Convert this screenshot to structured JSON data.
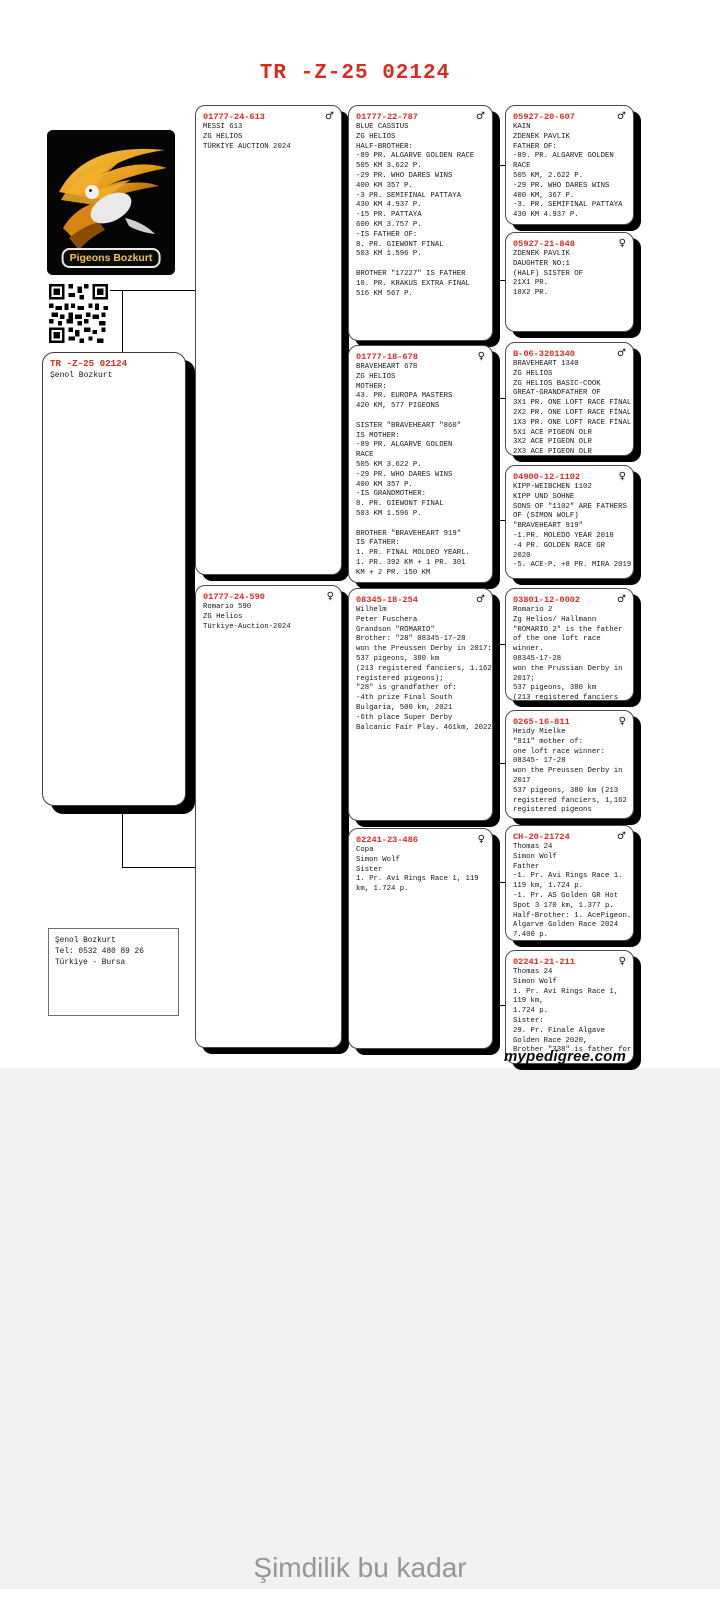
{
  "title": "TR -Z-25 02124",
  "logo": {
    "label": "Pigeons Bozkurt"
  },
  "subject": {
    "ring": "TR -Z-25 02124",
    "owner": "Şenol Bozkurt"
  },
  "contact": {
    "lines": [
      "Şenol Bozkurt",
      "Tel: 0532 480 89 26",
      "Türkiye - Bursa"
    ]
  },
  "footer": {
    "site": "mypedigree.com",
    "end_text": "Şimdilik bu kadar"
  },
  "cards": [
    {
      "ring": "01777-24-613",
      "sex": "m",
      "lines": [
        "MESSI 613",
        "ZG HELIOS",
        "TÜRKİYE AUCTION 2024"
      ]
    },
    {
      "ring": "01777-22-787",
      "sex": "m",
      "lines": [
        "BLUE CASSIUS",
        "ZG HELIOS",
        "HALF-BROTHER:",
        "-89 PR. ALGARVE GOLDEN RACE",
        "505 KM 3.622 P.",
        "-29 PR. WHO DARES WINS",
        "400 KM 357 P.",
        "-3 PR. SEMIFINAL PATTAYA",
        "430 KM 4.937 P.",
        "-15 PR. PATTAYA",
        "600 KM 3.757 P.",
        "-IS FATHER OF:",
        "8. PR. GIEWONT FINAL",
        "503 KM 1.596 P.",
        "",
        "BROTHER \"17227\" IS FATHER",
        "10. PR. KRAKUS EXTRA FINAL",
        "516 KM 567 P."
      ]
    },
    {
      "ring": "05927-20-607",
      "sex": "m",
      "lines": [
        "KAIN",
        "ZDENEK PAVLIK",
        "FATHER OF:",
        "-89. PR. ALGARVE GOLDEN",
        "RACE",
        "505 KM, 2.622 P.",
        "-29 PR. WHO DARES WINS",
        "400 KM, 367 P.",
        "-3. PR. SEMIFINAL PATTAYA",
        "430 KM 4.937 P."
      ]
    },
    {
      "ring": "05927-21-848",
      "sex": "f",
      "lines": [
        "ZDENEK PAVLIK",
        "DAUGHTER NO:1",
        "(HALF) SISTER OF",
        "21X1 PR.",
        "18X2 PR."
      ]
    },
    {
      "ring": "01777-18-678",
      "sex": "f",
      "lines": [
        "BRAVEHEART 678",
        "ZG HELIOS",
        "MOTHER:",
        "43. PR. EUROPA MASTERS",
        "420 KM, 577 PIGEONS",
        "",
        "SISTER \"BRAVEHEART \"860\"",
        "IS MOTHER:",
        "-89 PR. ALGARVE GOLDEN",
        "RACE",
        "505 KM 3.622 P.",
        "-29 PR. WHO DARES WINS",
        "400 KM 357 P.",
        "-IS GRANDMOTHER:",
        "8. PR. GIEWONT FINAL",
        "503 KM 1.596 P.",
        "",
        "BROTHER \"BRAVEHEART 919\"",
        "IS FATHER:",
        "1. PR. FINAL MOLDEO YEARL.",
        "1. PR. 392 KM + 1 PR. 301",
        "KM + 2 PR. 150 KM"
      ]
    },
    {
      "ring": "B-06-3201340",
      "sex": "m",
      "lines": [
        "BRAVEHEART 1340",
        "ZG HELIOS",
        "ZG HELIOS BASIC-COOK",
        "GREAT-GRANDFATHER OF",
        "3X1 PR. ONE LOFT RACE FİNAL",
        "2X2 PR. ONE LOFT RACE FİNAL",
        "1X3 PR. ONE LOFT RACE FİNAL",
        "5X1 ACE PIGEON OLR",
        "3X2 ACE PIGEON OLR",
        "2X3 ACE PIGEON OLR"
      ]
    },
    {
      "ring": "04900-12-1102",
      "sex": "f",
      "lines": [
        "KIPP-WEIBCHEN 1102",
        "KIPP UND SOHNE",
        "SONS OF \"1102\" ARE FATHERS",
        "OF (SIMON WOLF)",
        "\"BRAVEHEART 919\"",
        "-1.PR. MOLEDO YEAR 2018",
        "-4 PR. GOLDEN RACE GR",
        "2020",
        "-5. ACE-P. +8 PR. MIRA 2019"
      ]
    },
    {
      "ring": "01777-24-590",
      "sex": "f",
      "lines": [
        "Romario 590",
        "ZG Helios",
        "Türkiye-Auction-2024"
      ]
    },
    {
      "ring": "08345-18-254",
      "sex": "m",
      "lines": [
        "Wilhelm",
        "Peter Fuschera",
        "Grandson \"ROMARIO\"",
        "Brother: \"28\" 08345-17-28",
        "won the Preussen Derby in 2017:",
        "537 pigeons, 380 km",
        "(213 registered fanciers, 1.162",
        "registered pigeons);",
        "\"28\" is grandfather of:",
        "-4th prize Final South",
        "Bulgaria, 500 km, 2021",
        "-6th place Super Derby",
        "Balcanic Fair Play. 461km, 2022"
      ]
    },
    {
      "ring": "03801-12-0002",
      "sex": "m",
      "lines": [
        "Romario 2",
        "Zg Helios/ Hallmann",
        "\"ROMARIO 2\" is the father",
        "of the one loft race",
        "winner.",
        "08345-17-28",
        "won the Prussian Derby in",
        "2017;",
        "537 pigeons, 380 km",
        "(213 registered fanciers"
      ]
    },
    {
      "ring": "0265-16-811",
      "sex": "f",
      "lines": [
        "Heidy Mielke",
        "\"811\" mother of:",
        "one loft race winner:",
        "08345- 17-28",
        "won the Preussen Derby in",
        "2017",
        "537 pigeons, 380 km (213",
        "registered fanciers, 1,162",
        "registered pigeons"
      ]
    },
    {
      "ring": "02241-23-486",
      "sex": "f",
      "lines": [
        "Copa",
        "Simon Wolf",
        "Sister",
        "1. Pr. Avi Rings Race 1, 119",
        "km, 1.724 p."
      ]
    },
    {
      "ring": "CH-20-21724",
      "sex": "m",
      "lines": [
        "Thomas 24",
        "Simon Wolf",
        "Father",
        "-1. Pr. Avi Rings Race 1.",
        "119 km, 1.724 p.",
        "-1. Pr. AS Golden GR Hot",
        "Spot 3 170 km, 1.377 p.",
        "Half-Brother: 1. AcePigeon.",
        "Algarve Golden Race 2024",
        "7.400 p."
      ]
    },
    {
      "ring": "02241-21-211",
      "sex": "f",
      "lines": [
        "Thomas 24",
        "Simon Wolf",
        "1. Pr. Avi Rings Race 1,",
        "119 km,",
        "1.724 p.",
        "Sister:",
        "29. Pr. Finale Algave",
        "Golden Race 2020,",
        "Brother \"338\" is father for"
      ]
    }
  ]
}
